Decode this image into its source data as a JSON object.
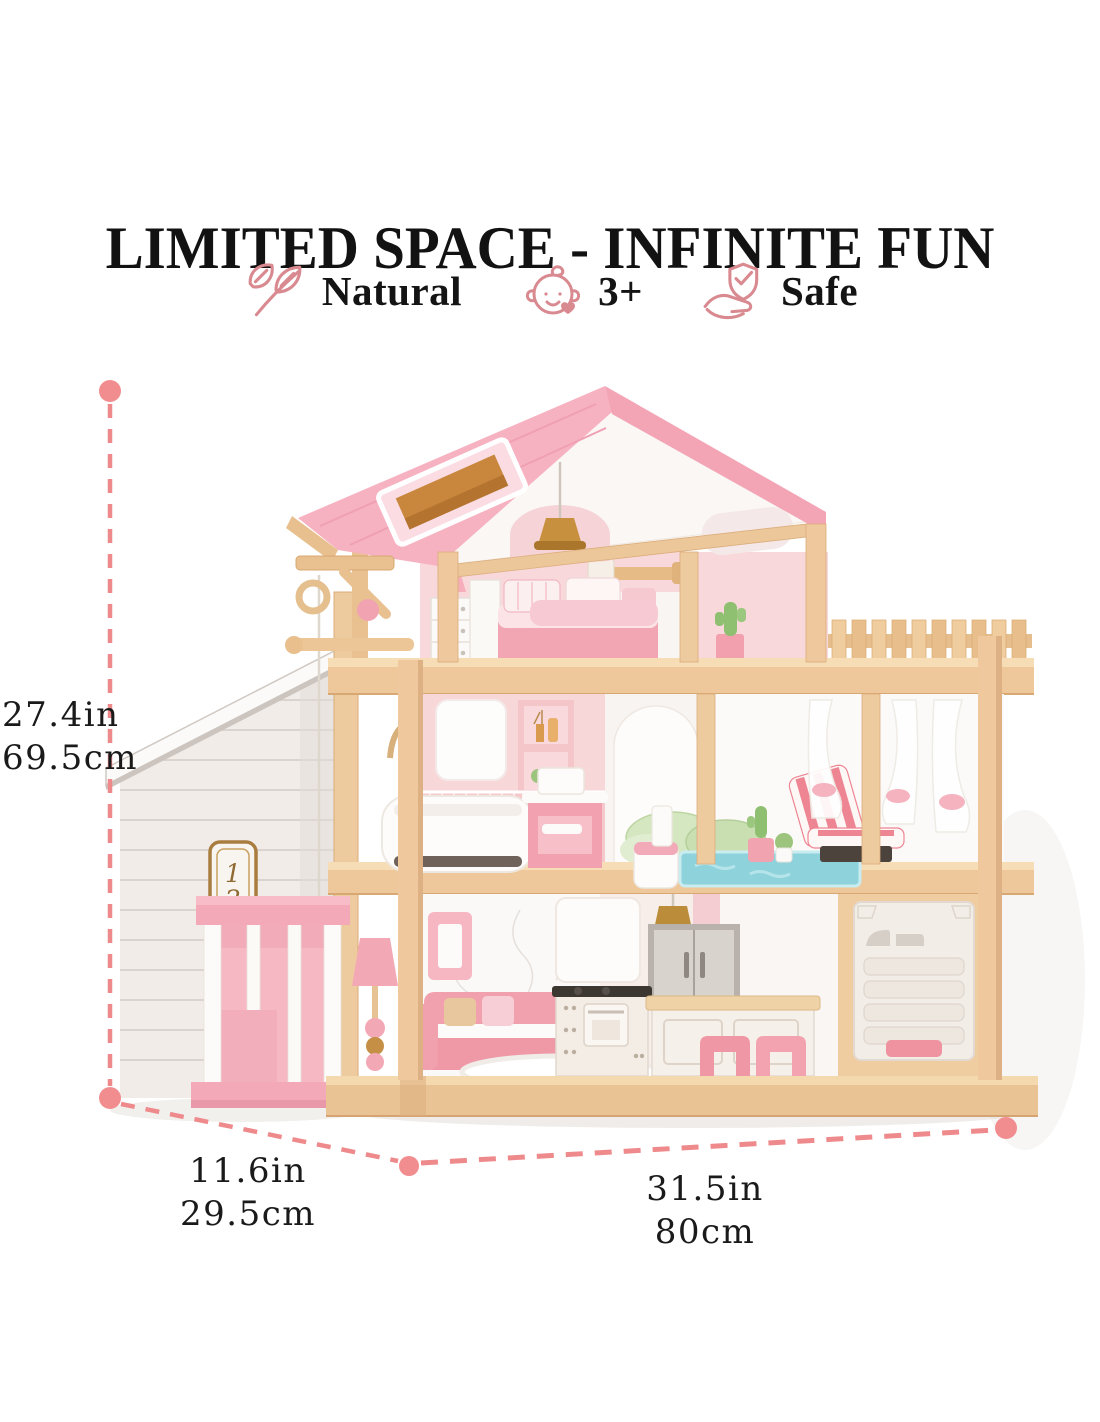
{
  "title": "LIMITED SPACE - INFINITE FUN",
  "badges": [
    {
      "icon": "leaf-icon",
      "label": "Natural"
    },
    {
      "icon": "baby-icon",
      "label": "3+"
    },
    {
      "icon": "shield-hand-icon",
      "label": "Safe"
    }
  ],
  "dimensions": {
    "height_in": "27.4in",
    "height_cm": "69.5cm",
    "depth_in": "11.6in",
    "depth_cm": "29.5cm",
    "width_in": "31.5in",
    "width_cm": "80cm"
  },
  "house_sign": {
    "full": "1204",
    "digits": [
      "1",
      "2",
      "0",
      "4"
    ]
  },
  "colors": {
    "accent_dash_pink": "#ee8a8c",
    "icon_rose": "#d98a90",
    "roof_pink": "#f7b2c1",
    "wood_tan": "#eecb9e",
    "furniture_pink": "#f1a0ae",
    "pool_blue": "#8ed2dc",
    "text_black": "#141414"
  }
}
